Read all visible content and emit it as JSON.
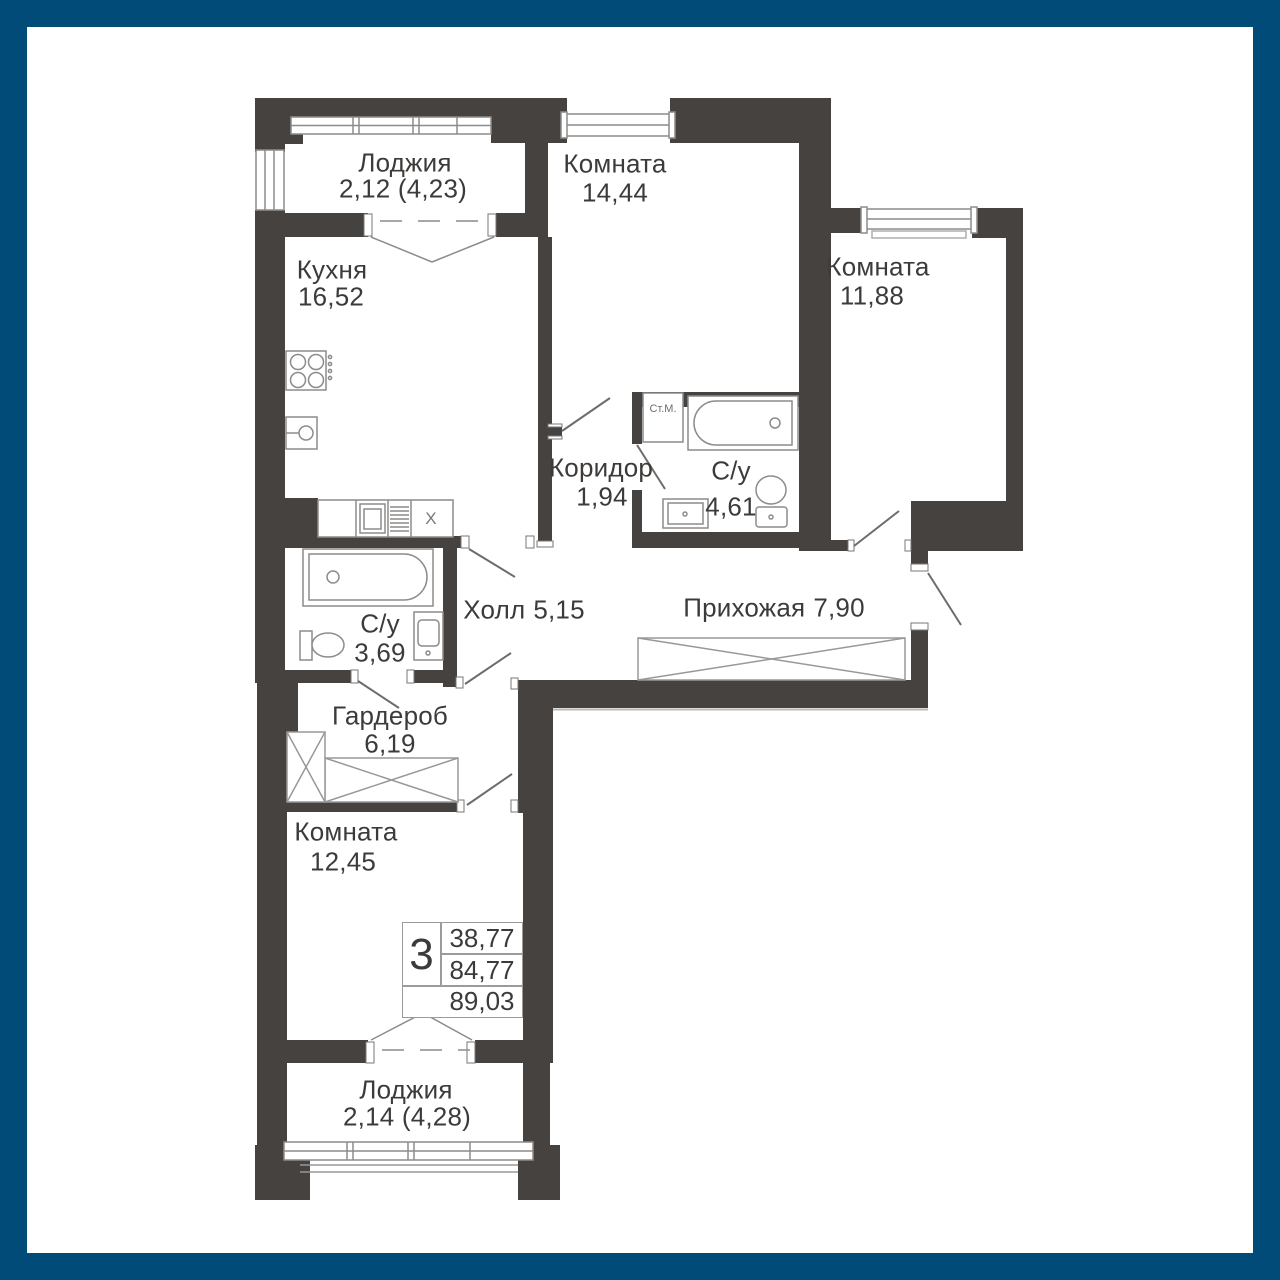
{
  "plan": {
    "rooms": [
      {
        "name": "Лоджия",
        "area": "2,12 (4,23)"
      },
      {
        "name": "Кухня",
        "area": "16,52"
      },
      {
        "name": "Комната",
        "area": "14,44"
      },
      {
        "name": "Комната",
        "area": "11,88"
      },
      {
        "name": "Коридор",
        "area": "1,94"
      },
      {
        "name": "С/у",
        "area": "4,61"
      },
      {
        "name": "Холл",
        "area": "5,15"
      },
      {
        "name": "Прихожая",
        "area": "7,90"
      },
      {
        "name": "С/у",
        "area": "3,69"
      },
      {
        "name": "Гардероб",
        "area": "6,19"
      },
      {
        "name": "Комната",
        "area": "12,45"
      },
      {
        "name": "Лоджия",
        "area": "2,14 (4,28)"
      }
    ],
    "fixture_labels": {
      "washing_machine": "Ст.М.",
      "kitchen_x_marker": "X"
    },
    "info_box": {
      "rooms_count": "3",
      "living_area": "38,77",
      "apartment_area": "84,77",
      "total_area": "89,03"
    },
    "colors": {
      "frame_blue": "#004b78",
      "wall_dark": "#454240",
      "text": "#3d3b39",
      "thin_line": "#8e8c8a"
    }
  }
}
